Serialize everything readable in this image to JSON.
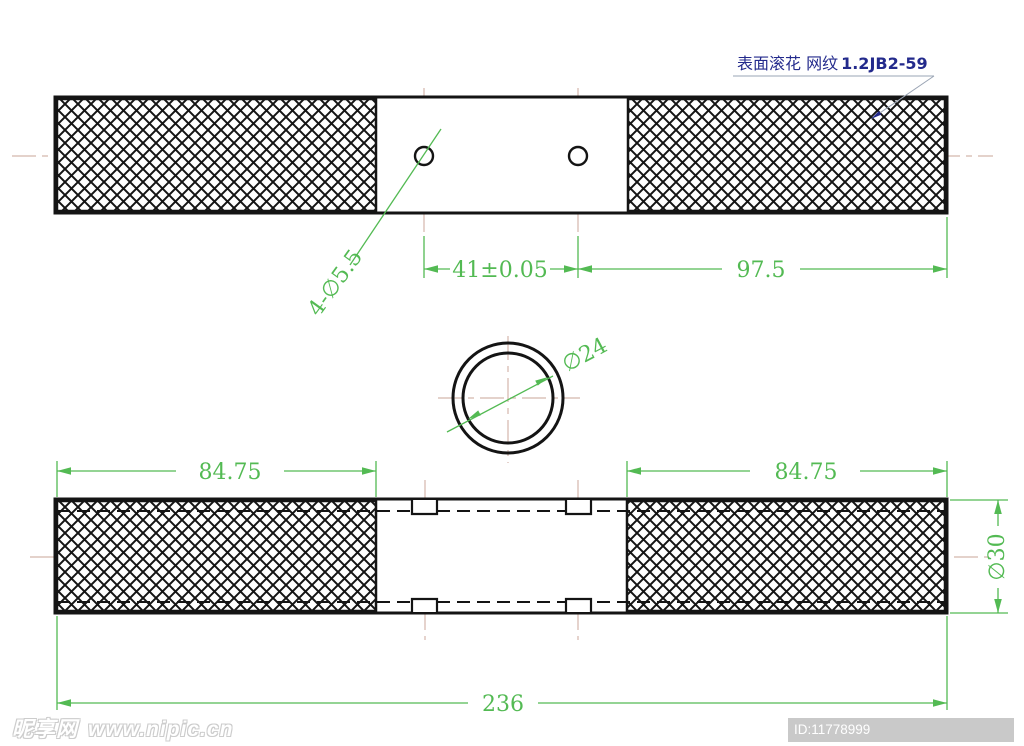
{
  "colors": {
    "dimension_green": "#53ba53",
    "centerline_tan": "#d4b6ac",
    "outline_black": "#141414",
    "note_navy": "#232a8c",
    "id_badge_gray": "#c9c9c9"
  },
  "note": {
    "text_cn": "表面滚花  网纹",
    "code": "1.2JB2-59"
  },
  "top_view": {
    "hole_callout": "4-∅5.5",
    "dim_hole_spacing": "41±0.05",
    "dim_right_knurl": "97.5"
  },
  "section_view": {
    "dim_bore_diameter": "∅24"
  },
  "bottom_view": {
    "dim_knurl_left": "84.75",
    "dim_knurl_right": "84.75",
    "dim_outer_diameter": "∅30",
    "dim_total_length": "236"
  },
  "watermark": {
    "site_name": "昵享网",
    "site_url": "www.nipic.cn",
    "id_text": "ID:11778999 NO:20180810111552634123"
  }
}
